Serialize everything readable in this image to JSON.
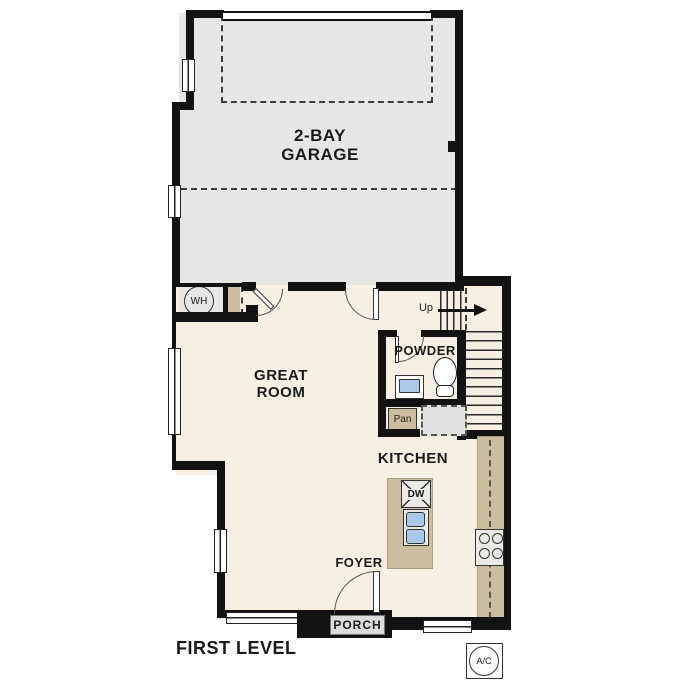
{
  "title": "FIRST LEVEL",
  "rooms": {
    "garage_line1": "2-BAY",
    "garage_line2": "GARAGE",
    "great_line1": "GREAT",
    "great_line2": "ROOM",
    "kitchen": "KITCHEN",
    "powder": "POWDER",
    "foyer": "FOYER",
    "porch": "PORCH",
    "pantry": "Pan"
  },
  "fixtures": {
    "water_heater": "WH",
    "dishwasher": "DW",
    "ac_unit": "A/C",
    "stairs_direction": "Up"
  },
  "colors": {
    "wall": "#121212",
    "garage_floor": "#e7e6e4",
    "interior_floor": "#f6efe2",
    "cabinet_tan": "#cbbda0",
    "fixture_gray": "#eceae7",
    "sink_blue": "#aac9e8"
  }
}
